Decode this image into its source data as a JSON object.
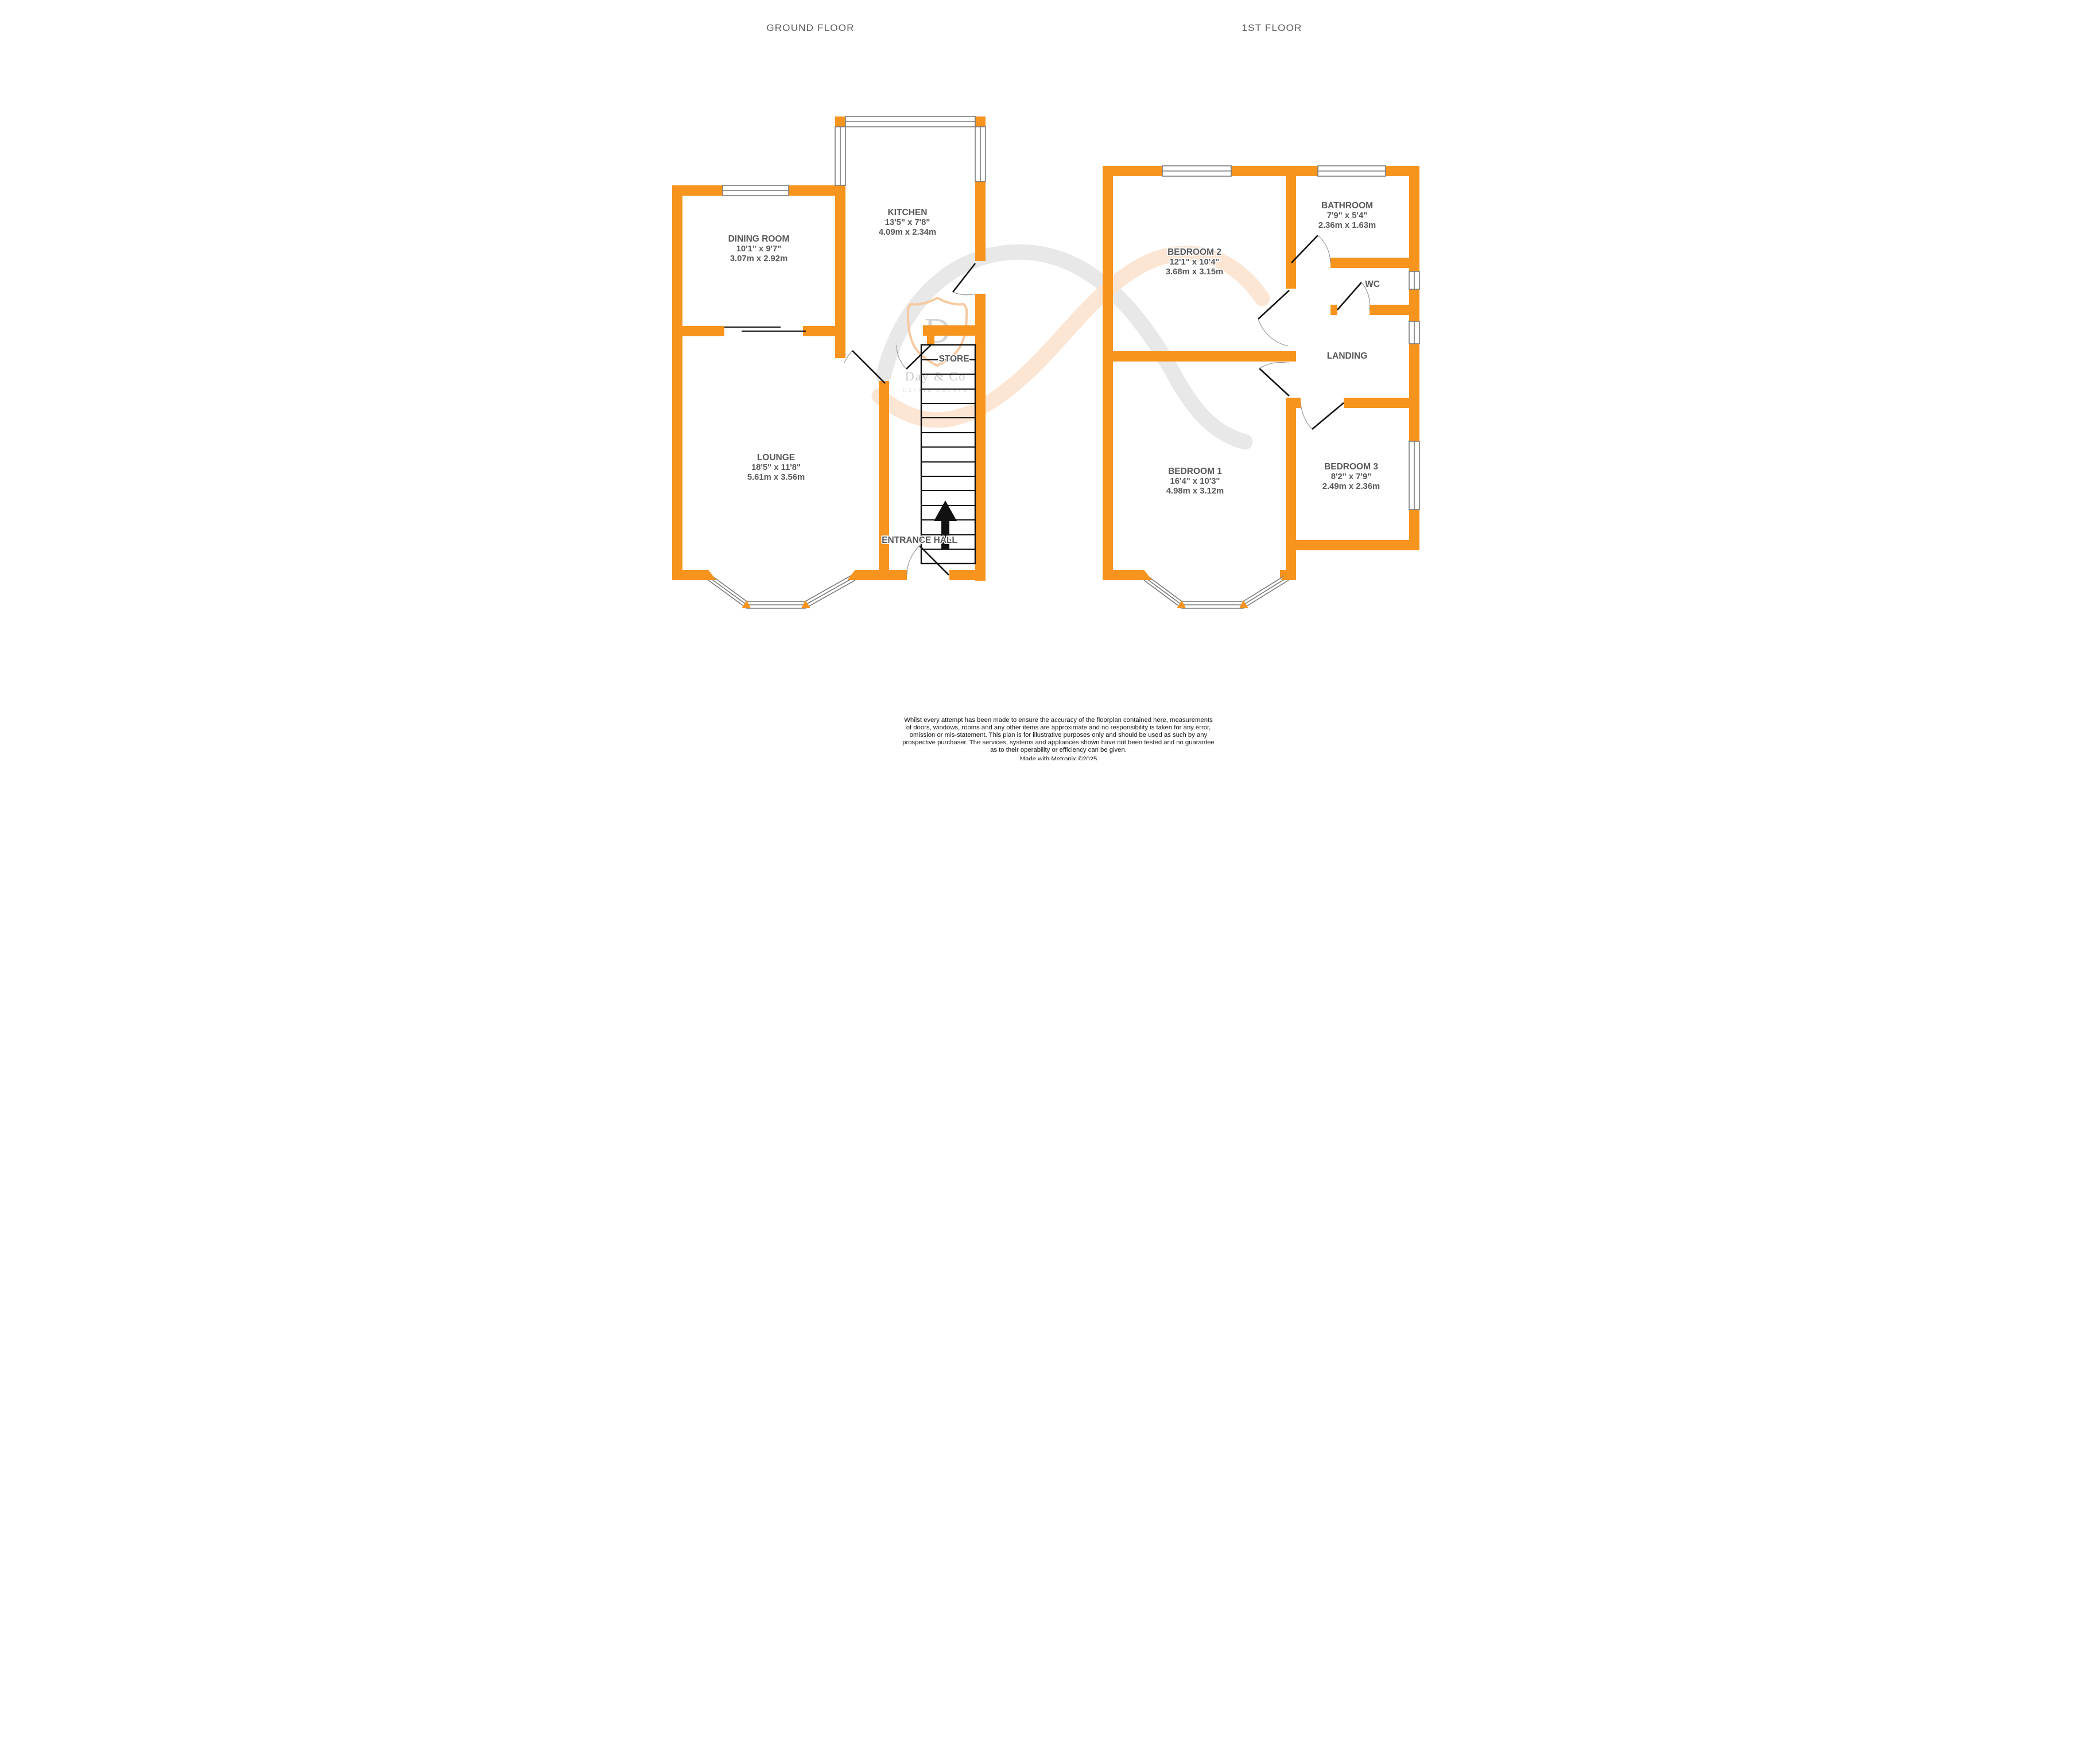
{
  "colors": {
    "wall_orange": "#F7941E",
    "window_gray": "#7b7b7b",
    "label_gray": "#58595b"
  },
  "floors": {
    "ground": {
      "title": "GROUND FLOOR",
      "rooms": {
        "dining_room": {
          "name": "DINING ROOM",
          "imperial": "10'1\" x 9'7\"",
          "metric": "3.07m x 2.92m"
        },
        "kitchen": {
          "name": "KITCHEN",
          "imperial": "13'5\" x 7'8\"",
          "metric": "4.09m x 2.34m"
        },
        "lounge": {
          "name": "LOUNGE",
          "imperial": "18'5\" x 11'8\"",
          "metric": "5.61m x 3.56m"
        },
        "store": {
          "name": "STORE"
        },
        "entrance_hall": {
          "name": "ENTRANCE HALL"
        }
      },
      "stairs_direction": "UP"
    },
    "first": {
      "title": "1ST FLOOR",
      "rooms": {
        "bedroom_2": {
          "name": "BEDROOM 2",
          "imperial": "12'1\" x 10'4\"",
          "metric": "3.68m x 3.15m"
        },
        "bathroom": {
          "name": "BATHROOM",
          "imperial": "7'9\" x 5'4\"",
          "metric": "2.36m x 1.63m"
        },
        "wc": {
          "name": "WC"
        },
        "landing": {
          "name": "LANDING"
        },
        "bedroom_1": {
          "name": "BEDROOM 1",
          "imperial": "16'4\" x 10'3\"",
          "metric": "4.98m x 3.12m"
        },
        "bedroom_3": {
          "name": "BEDROOM 3",
          "imperial": "8'2\" x 7'9\"",
          "metric": "2.49m x 2.36m"
        }
      }
    }
  },
  "watermark": {
    "monogram": "D",
    "name": "Day & Co",
    "tagline": "ESTATE AGENTS"
  },
  "disclaimer": {
    "lines": [
      "Whilst every attempt has been made to ensure the accuracy of the floorplan contained here, measurements",
      "of doors, windows, rooms and any other items are approximate and no responsibility is taken for any error,",
      "omission or mis-statement. This plan is for illustrative purposes only and should be used as such by any",
      "prospective purchaser. The services, systems and appliances shown have not been tested and no guarantee",
      "as to their operability or efficiency can be given."
    ],
    "credit": "Made with Metropix ©2025"
  }
}
